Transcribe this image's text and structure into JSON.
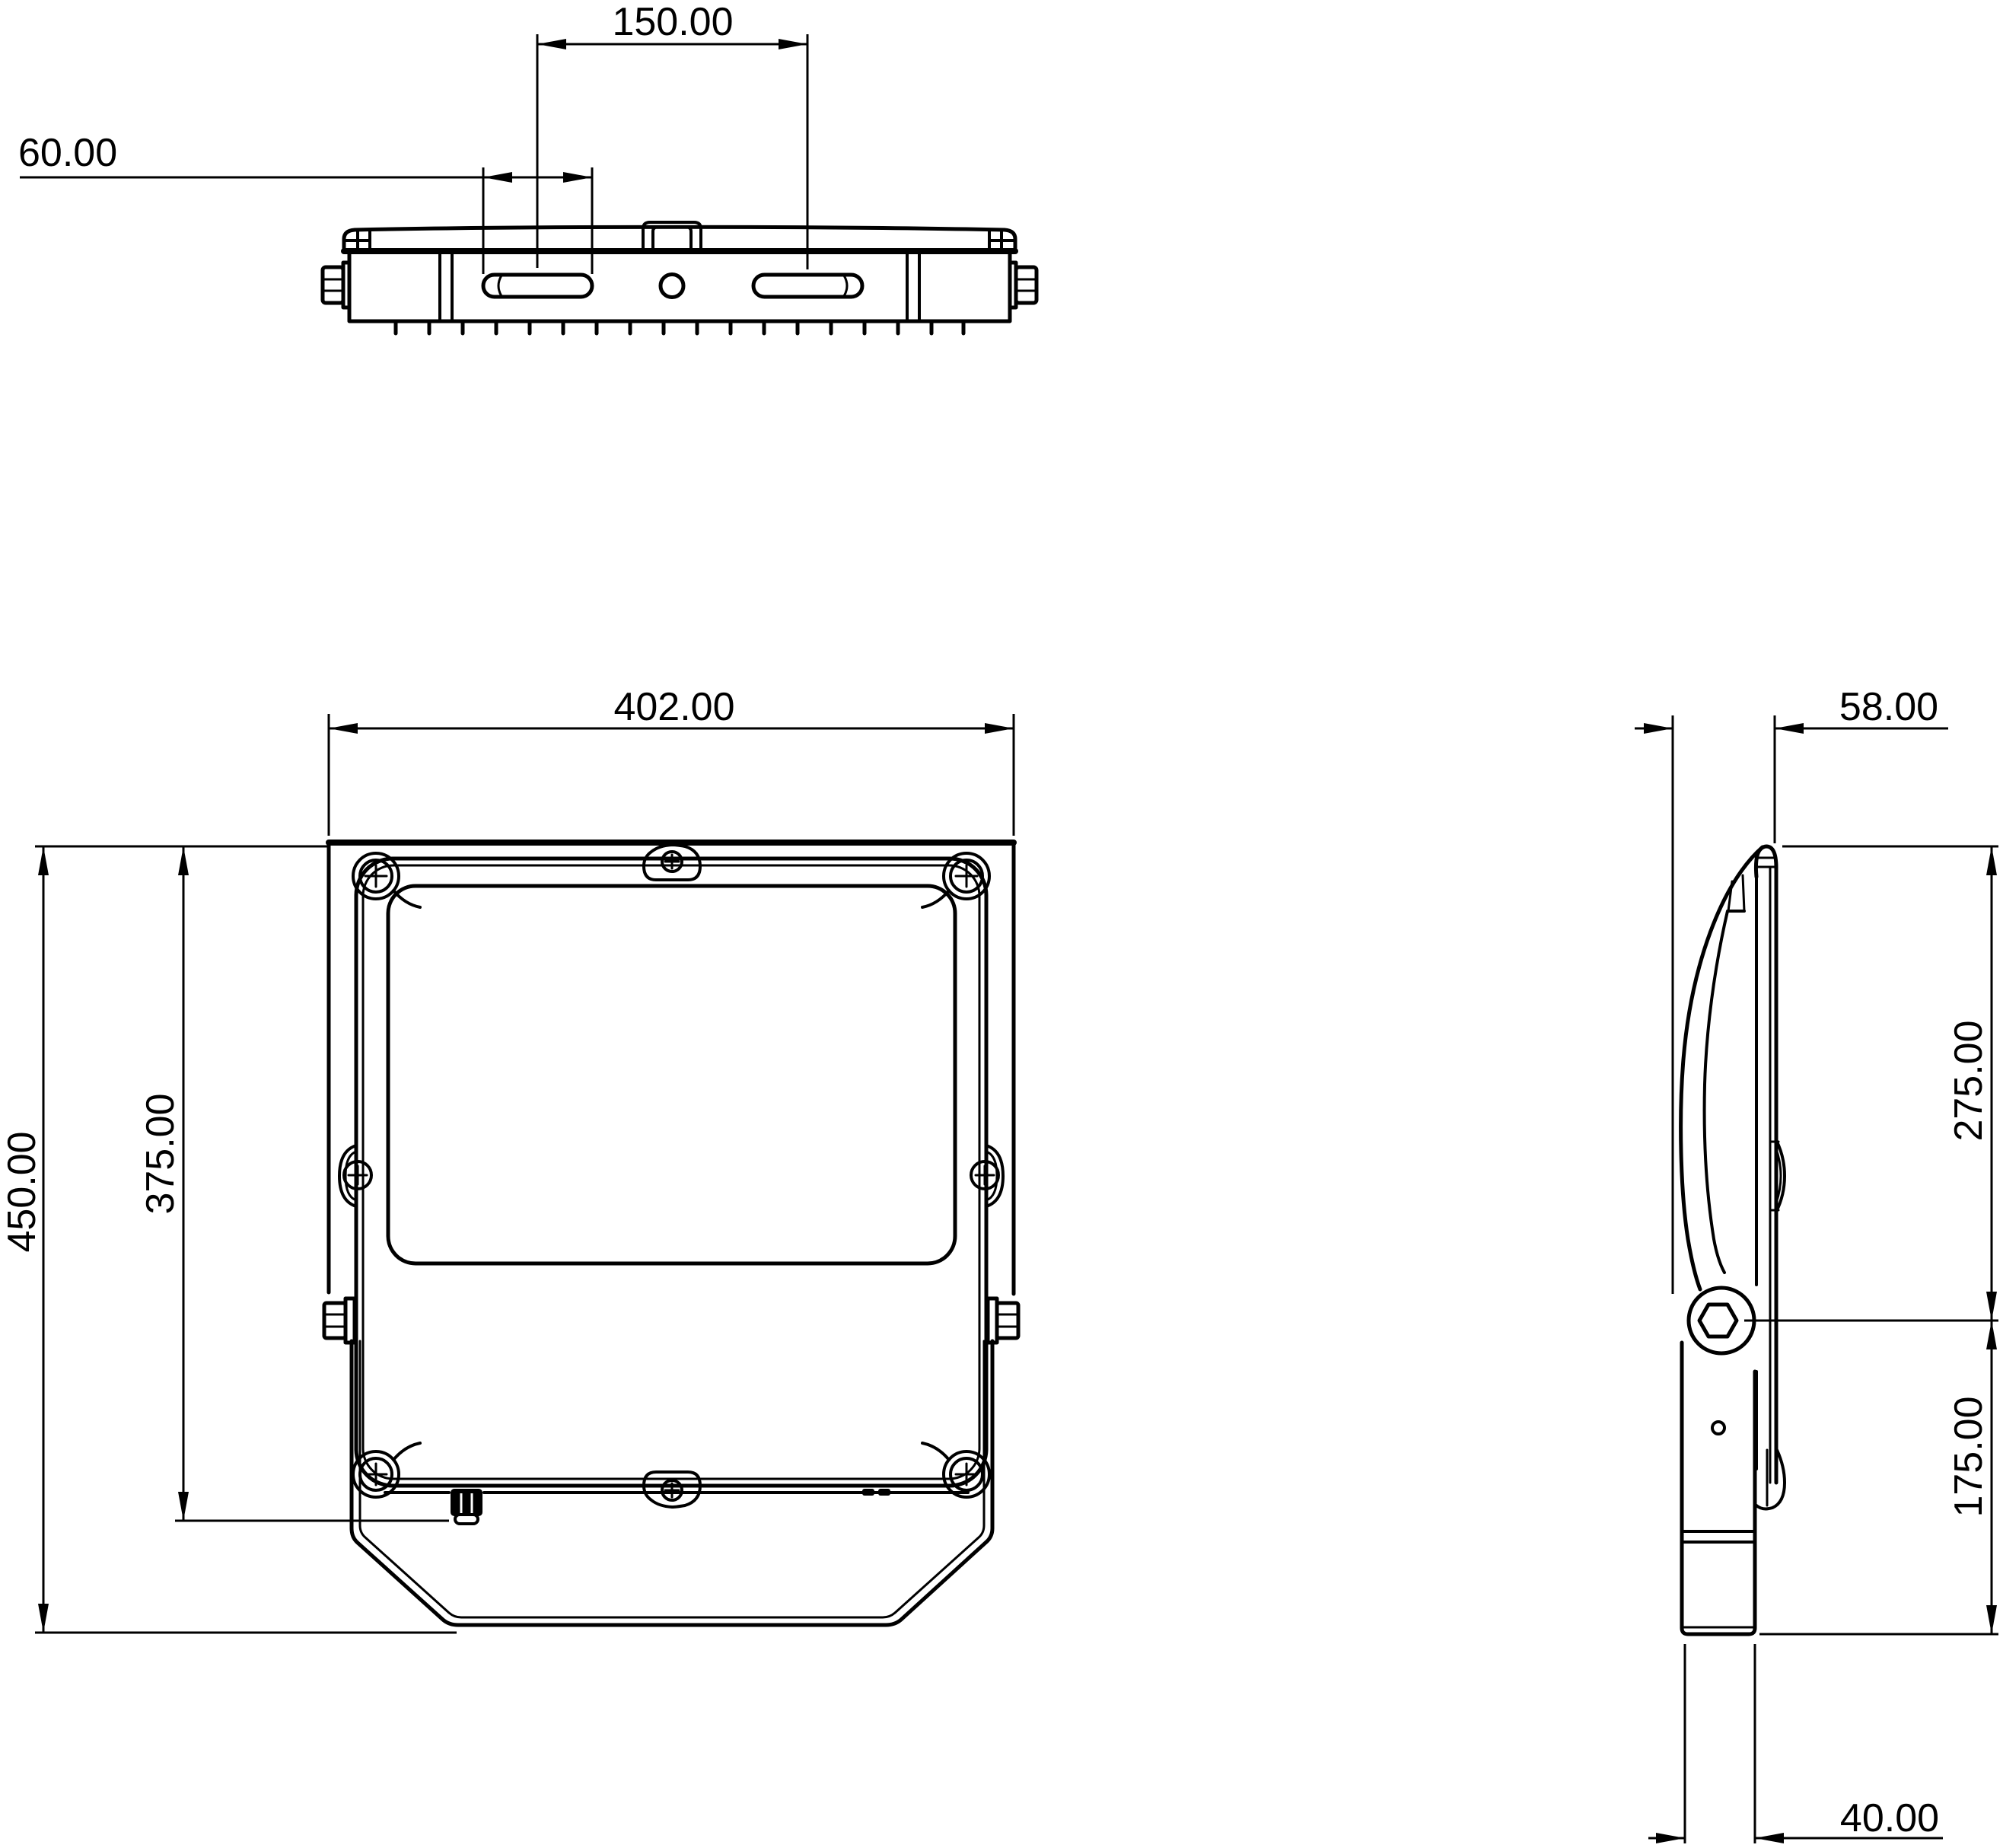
{
  "colors": {
    "ink": "#000000",
    "background": "#ffffff"
  },
  "dimensions": {
    "top_view": {
      "slot_center_spacing": "150.00",
      "slot_length": "60.00"
    },
    "front_view": {
      "width": "402.00",
      "overall_height": "450.00",
      "mounting_height": "375.00"
    },
    "side_view": {
      "depth": "58.00",
      "upper_height": "275.00",
      "lower_height": "175.00",
      "foot_width": "40.00"
    }
  }
}
